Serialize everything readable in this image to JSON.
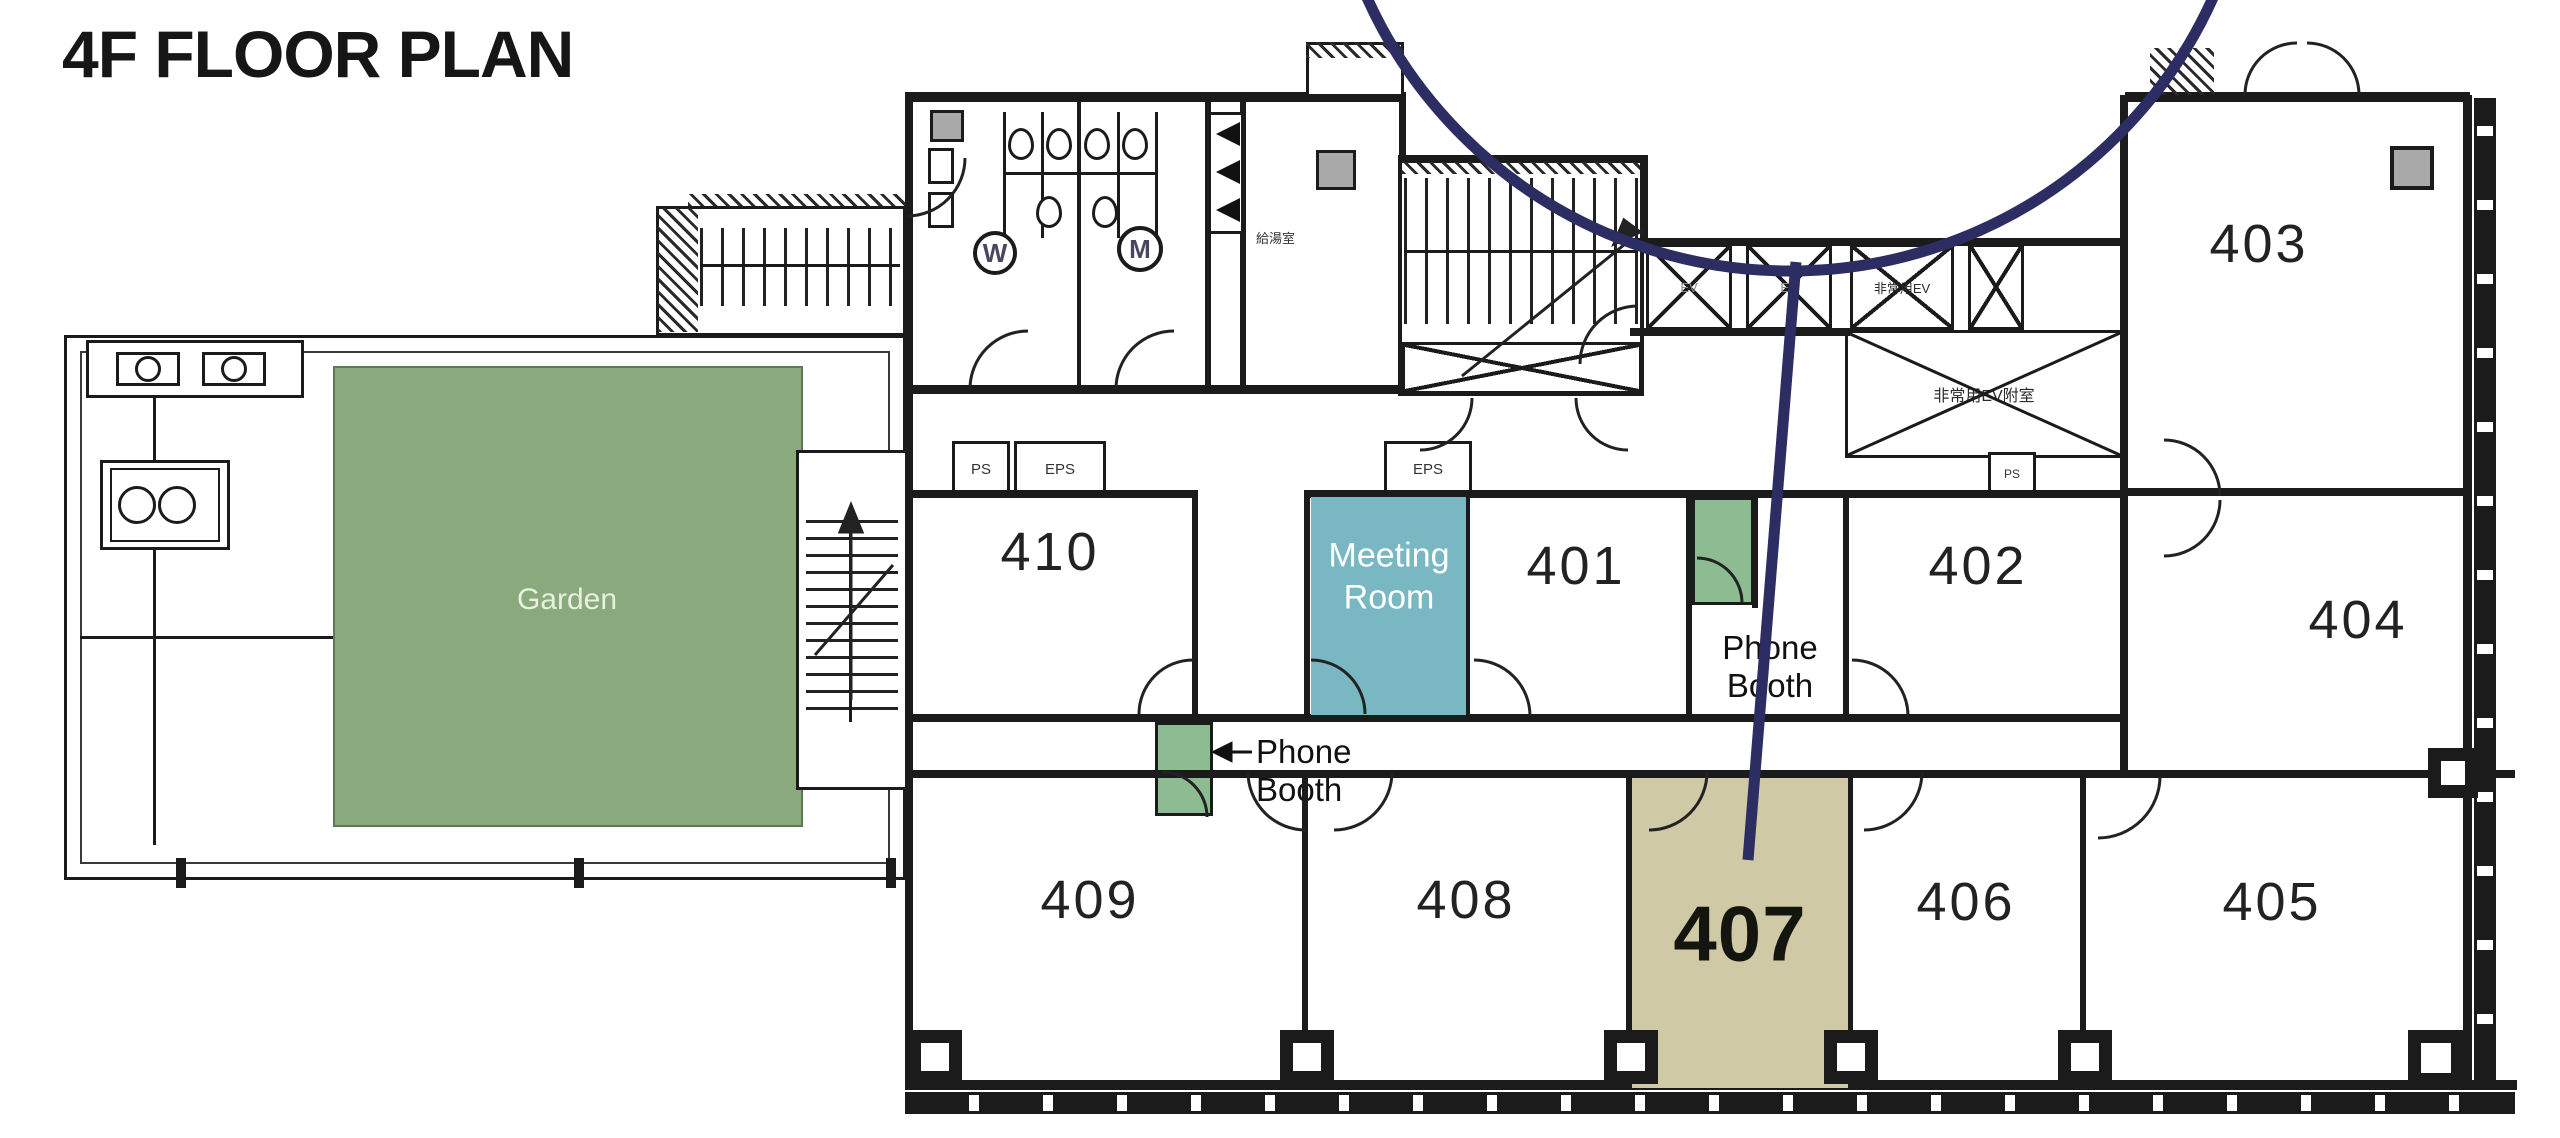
{
  "title": "4F FLOOR PLAN",
  "colors": {
    "callout": "#2b2d63",
    "garden": "#8aa97c",
    "meeting": "#79b7c3",
    "booth": "#8dbb92",
    "room407": "#cfc9a6"
  },
  "garden": {
    "label": "Garden"
  },
  "meeting_room": {
    "line1": "Meeting",
    "line2": "Room"
  },
  "phone_booth": {
    "line1": "Phone",
    "line2": "Booth"
  },
  "rooms": {
    "r401": "401",
    "r402": "402",
    "r403": "403",
    "r404": "404",
    "r405": "405",
    "r406": "406",
    "r407": "407",
    "r408": "408",
    "r409": "409",
    "r410": "410"
  },
  "core": {
    "womens": "W",
    "mens": "M",
    "ev": "EV",
    "emergency_ev": "非常用EV",
    "emergency_ev_lobby": "非常用EV附室",
    "kitchenette": "給湯室",
    "ps": "PS",
    "eps": "EPS"
  }
}
